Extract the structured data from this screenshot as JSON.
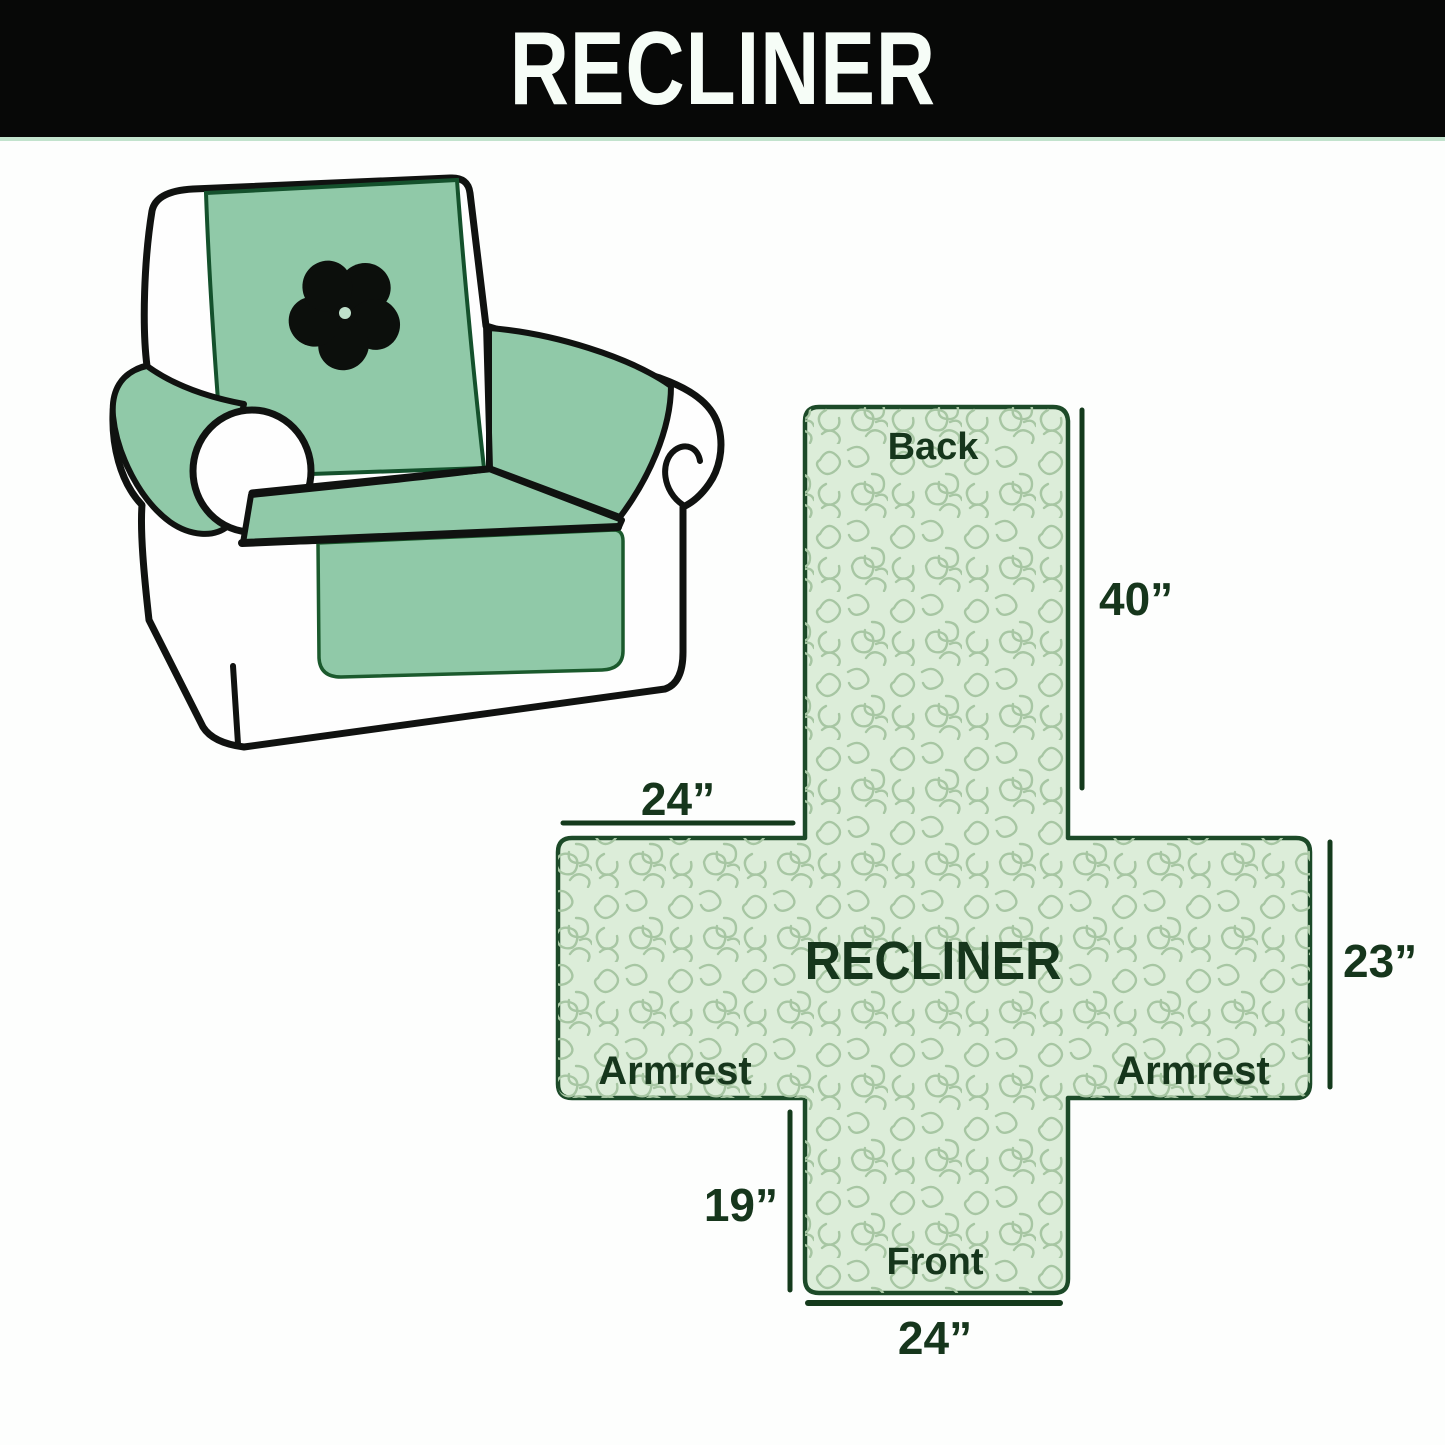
{
  "header": {
    "title": "RECLINER"
  },
  "diagram": {
    "center_label": "RECLINER",
    "back_label": "Back",
    "front_label": "Front",
    "armrest_left_label": "Armrest",
    "armrest_right_label": "Armrest",
    "dims": {
      "back_length": "40”",
      "armrest_top_width": "24”",
      "armrest_depth": "23”",
      "front_length": "19”",
      "front_width": "24”"
    }
  },
  "illustration": {
    "subject": "recliner armchair with quilted protective cover",
    "logo_icon": "pinwheel-fan"
  },
  "colors": {
    "header_bg": "#070807",
    "header_text": "#f6fdf7",
    "cover_green": "#90c9a8",
    "cross_fill": "#dcedd9",
    "cross_outline": "#1c4a28",
    "squiggle": "#a7c6a3",
    "label_text": "#16361c",
    "chair_outline": "#101210"
  }
}
